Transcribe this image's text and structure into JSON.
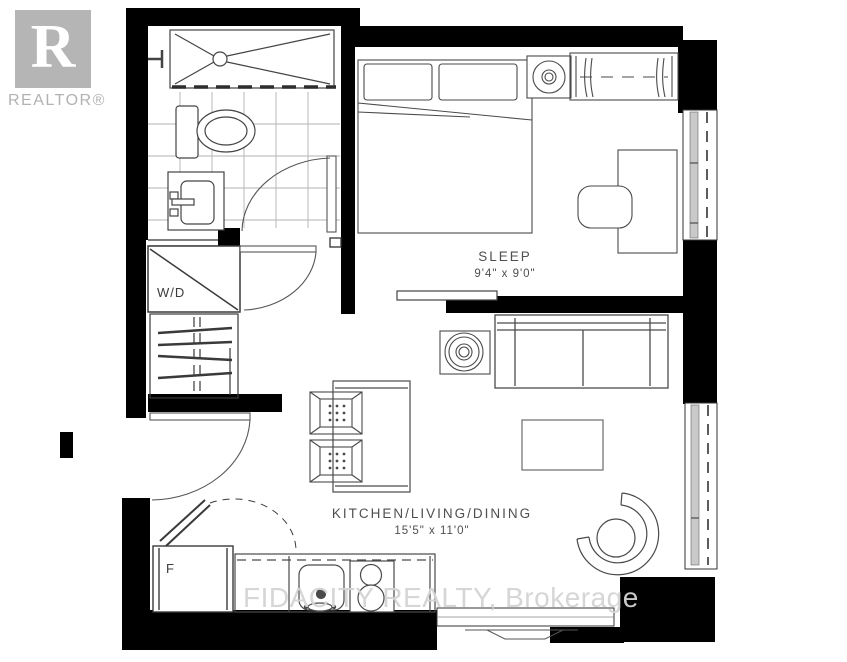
{
  "branding": {
    "logo_letter": "R",
    "logo_label": "REALTOR®"
  },
  "watermark": {
    "text": "FIDACITY REALTY, Brokerage"
  },
  "rooms": {
    "sleep": {
      "name": "SLEEP",
      "dims": "9'4\" x 9'0\""
    },
    "kitchen_living_dining": {
      "name": "KITCHEN/LIVING/DINING",
      "dims": "15'5\" x 11'0\""
    }
  },
  "labels": {
    "washer_dryer": "W/D",
    "fridge": "F"
  },
  "colors": {
    "wall": "#000000",
    "line": "#4a4a4a",
    "tile": "#b3b3b3",
    "logo_gray": "#b5b5b5",
    "watermark_gray": "#d4d4d4"
  }
}
